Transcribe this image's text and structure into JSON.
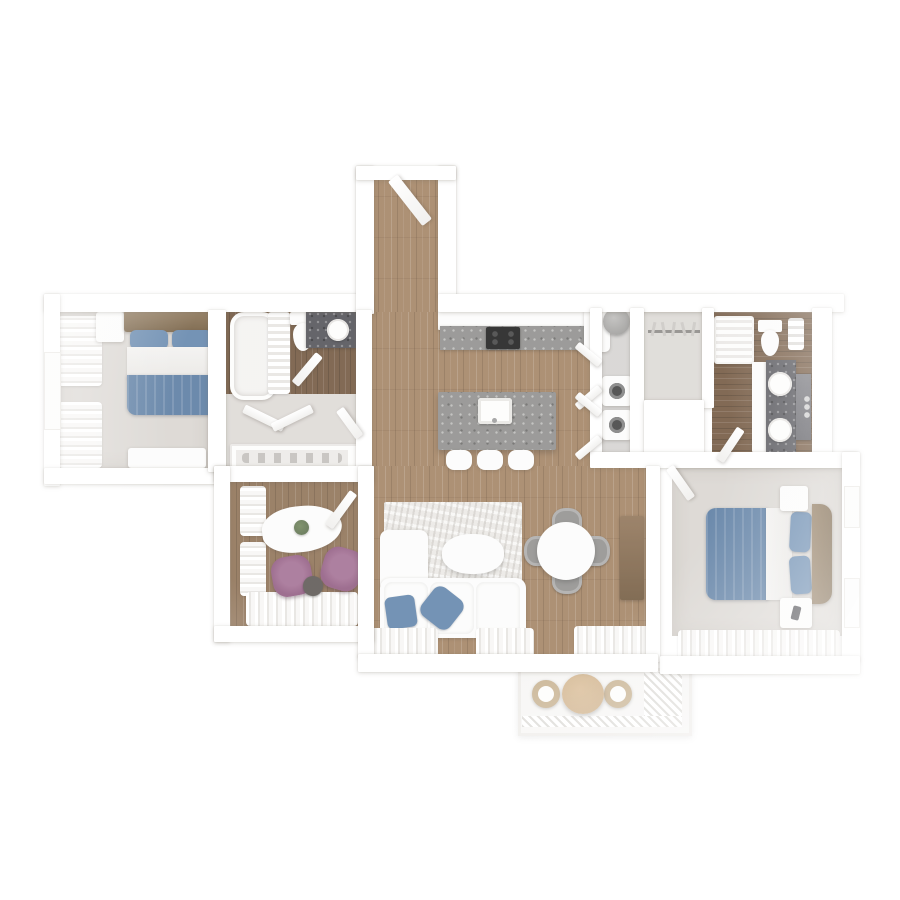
{
  "scene": {
    "title": "Top-down 3D rendered floor plan of a two-bedroom apartment",
    "style": "high-key white render, no text labels"
  },
  "palette": {
    "page_bg": "#ffffff",
    "wall": "#ffffff",
    "wood": "#a07f5e",
    "wood_den": "#8b6d50",
    "wood_dark": "#6e5239",
    "carpet": "#d8d4cf",
    "hall": "#dcd8d4",
    "walkin_floor": "#dbd8d4",
    "laundry_floor": "#d4d2d0",
    "white_furn": "#fcfcfb",
    "granite": "#8c8b89",
    "granite_dark": "#4c4c52",
    "bed_blue": "#54779e",
    "pillow_blue": "#5d81a9",
    "plum": "#8e577e",
    "chair_gray": "#8e8d8b",
    "plant_green": "#4f6242",
    "rattan": "#c3ab87",
    "balcony_table_wood": "#c8a87f",
    "cooktop_black": "#161616"
  },
  "rooms": {
    "entry": {
      "name": "Entry hallway",
      "floor": "wood",
      "items": [
        "open entry door"
      ]
    },
    "bedroom2": {
      "name": "Bedroom 2 (top left)",
      "floor": "carpet",
      "items": [
        "double bed with blue duvet and 2 blue pillows",
        "wood headboard",
        "bench",
        "dresser",
        "window curtains"
      ]
    },
    "bathroom": {
      "name": "Main bathroom",
      "floor": "dark wood",
      "items": [
        "bathtub",
        "towel radiator",
        "toilet",
        "vanity with round sink"
      ]
    },
    "hallway": {
      "name": "Inner hallway",
      "floor": "light gray",
      "items": [
        "open closet doors"
      ]
    },
    "closet": {
      "name": "Linen / shoe closet",
      "items": [
        "shelf with shoes"
      ]
    },
    "den": {
      "name": "Den / study",
      "floor": "wood",
      "items": [
        "organic white table",
        "potted plant",
        "2 plum armchairs",
        "round side table",
        "curtains"
      ]
    },
    "kitchen": {
      "name": "Kitchen",
      "floor": "wood",
      "items": [
        "granite counter",
        "black cooktop",
        "fridge",
        "granite island with sink",
        "3 bar stools",
        "open pantry doors"
      ]
    },
    "laundry": {
      "name": "Laundry / utility closet",
      "items": [
        "water heater",
        "stacked washer and dryer"
      ]
    },
    "walk_in_closet": {
      "name": "Walk-in closet",
      "items": [
        "hanging rod with hangers"
      ]
    },
    "ensuite": {
      "name": "En-suite bathroom",
      "floor": "dark wood",
      "items": [
        "glass shower",
        "toilet",
        "towel rack",
        "double vanity with 2 round sinks",
        "mirror"
      ]
    },
    "master_bedroom": {
      "name": "Master bedroom",
      "floor": "carpet",
      "items": [
        "double bed with blue duvet and 2 blue pillows",
        "2 nightstands",
        "2 windows",
        "curtains"
      ]
    },
    "living_dining": {
      "name": "Living / dining room",
      "floor": "wood",
      "items": [
        "white sectional sofa",
        "2 blue throw pillows",
        "distressed rug",
        "oval coffee table",
        "round dining table",
        "4 gray chairs",
        "wood media console",
        "curtains"
      ]
    },
    "balcony": {
      "name": "Balcony",
      "items": [
        "round wood table",
        "2 rattan chairs",
        "railing"
      ]
    }
  },
  "counts": {
    "bedrooms": 2,
    "bathrooms": 2,
    "bar_stools": 3,
    "dining_chairs": 4,
    "balcony_chairs": 2,
    "armchairs": 2
  }
}
